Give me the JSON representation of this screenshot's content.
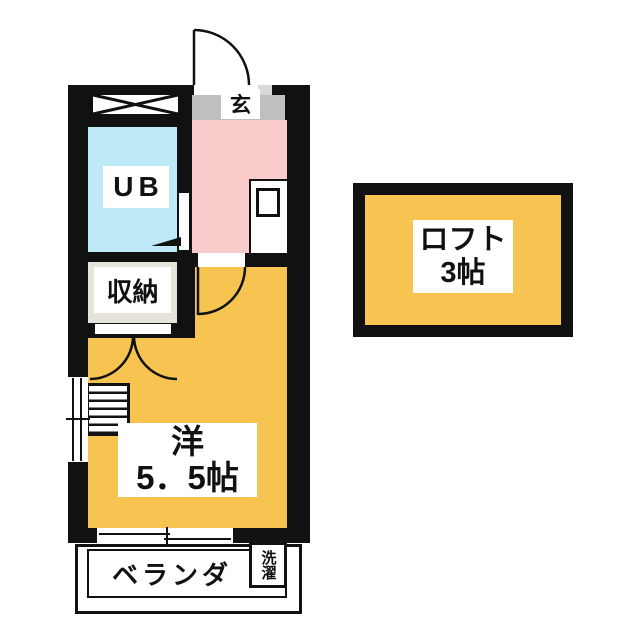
{
  "rooms": {
    "entrance": {
      "label": "玄"
    },
    "unit_bath": {
      "label": "UB"
    },
    "storage": {
      "label": "収納"
    },
    "western": {
      "name": "洋",
      "size": "5．5帖"
    },
    "balcony": {
      "label": "ベランダ"
    },
    "laundry": {
      "label": "洗濯"
    },
    "loft": {
      "name": "ロフト",
      "size": "3帖"
    }
  },
  "symbols": {
    "entrance_door": "quarter-circle door swing (opens out, top)",
    "interior_door": "quarter-circle door swing into main room",
    "closet_doors": "double outward door swing arcs",
    "ub_door": "triangle door marker into unit bath",
    "pipe_space": "box with X cross",
    "loft_ladder": "stair / ladder rungs",
    "sliding_window": "double-line sliding sash, bottom wall",
    "side_window": "double-line window, left wall",
    "kitchen_sink": "kitchenette with sink square"
  },
  "colors": {
    "wall": "#111111",
    "room_orange": "#F7C351",
    "room_pink": "#FACBCB",
    "room_cyan": "#BEE9F7",
    "room_beige": "#E6E3D8",
    "genkan_gray": "#BFBFBF",
    "step_gray": "#D9D9D9"
  }
}
